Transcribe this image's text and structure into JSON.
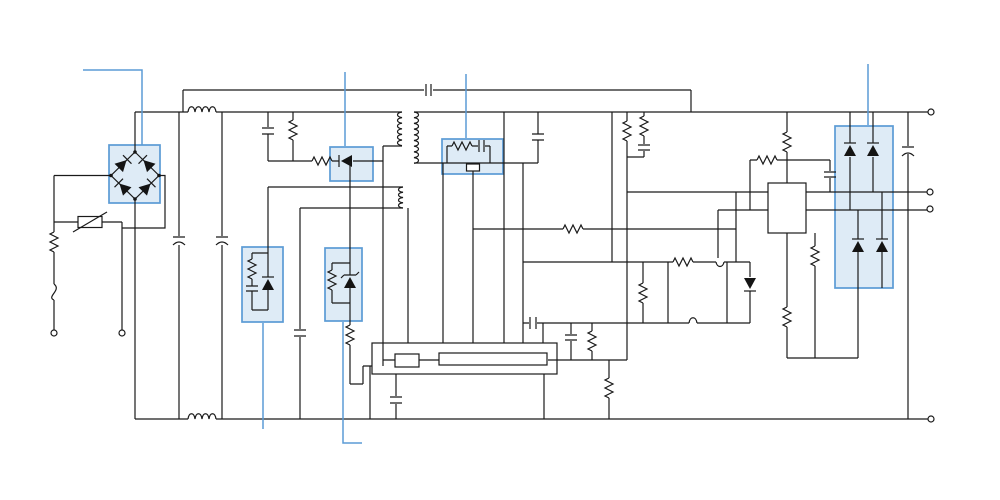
{
  "diagram": {
    "type": "circuit-schematic",
    "description": "Switch-mode power supply schematic with six highlighted components and callout leader lines",
    "canvas": {
      "width": 1000,
      "height": 500,
      "background": "#ffffff"
    },
    "colors": {
      "wire": "#1a1a1a",
      "highlight_fill": "#bdd7ee",
      "highlight_stroke": "#5b9bd5",
      "callout": "#5b9bd5"
    },
    "highlighted_components": [
      {
        "id": "bridge-rectifier",
        "label": "input bridge rectifier",
        "has_callout": true
      },
      {
        "id": "clamp-diode",
        "label": "primary RCD clamp diode",
        "has_callout": true
      },
      {
        "id": "rc-snubber",
        "label": "RC snubber over switching MOSFET",
        "has_callout": true
      },
      {
        "id": "zener-network-1",
        "label": "auxiliary zener/snubber network 1",
        "has_callout": true
      },
      {
        "id": "zener-network-2",
        "label": "auxiliary zener/snubber network 2",
        "has_callout": true
      },
      {
        "id": "output-rectifier",
        "label": "output rectifier diodes",
        "has_callout": true
      }
    ],
    "callout_count": 6,
    "components": {
      "input": [
        "ac-terminal-live",
        "ac-terminal-neutral",
        "fuse",
        "inrush-resistor",
        "varistor",
        "bridge-rectifier"
      ],
      "emi_filter": [
        "common-mode-choke",
        "bulk-capacitor-1",
        "bulk-capacitor-2",
        "x-capacitor",
        "bleeder-resistor"
      ],
      "primary": [
        "rcd-clamp-resistor",
        "rcd-clamp-diode",
        "transformer",
        "mosfet-switch",
        "rc-snubber",
        "y-capacitor",
        "pwm-controller-ic"
      ],
      "auxiliary": [
        "aux-winding",
        "zener-network-1",
        "zener-network-2",
        "aux-capacitor"
      ],
      "secondary": [
        "output-rectifier-diodes",
        "output-capacitor",
        "optocoupler-ic",
        "feedback-resistors",
        "current-limit-transistors",
        "current-limit-diode"
      ]
    },
    "terminals": {
      "input_count": 2,
      "output_count": 4
    }
  }
}
